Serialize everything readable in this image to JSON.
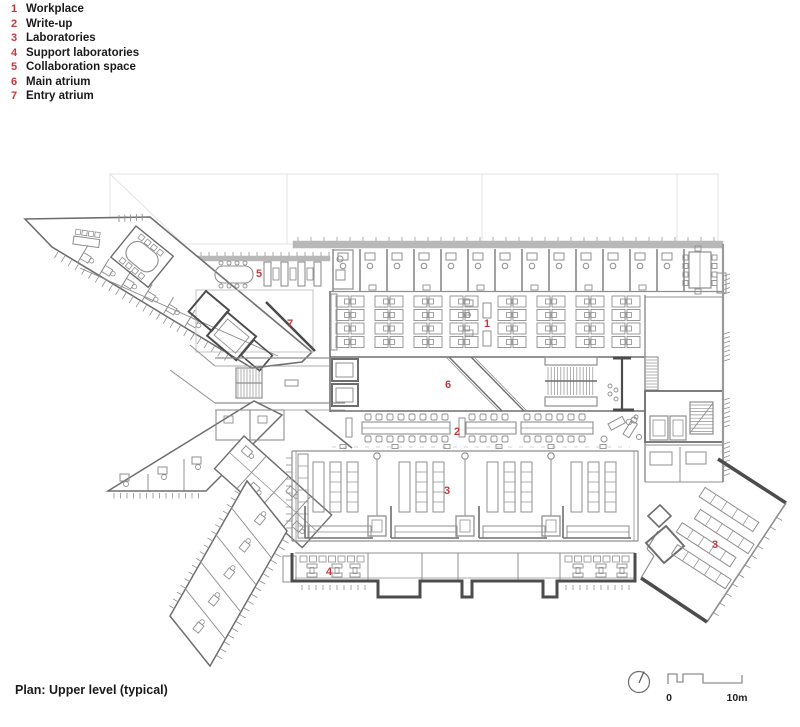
{
  "legend": {
    "items": [
      {
        "num": "1",
        "label": "Workplace"
      },
      {
        "num": "2",
        "label": "Write-up"
      },
      {
        "num": "3",
        "label": "Laboratories"
      },
      {
        "num": "4",
        "label": "Support laboratories"
      },
      {
        "num": "5",
        "label": "Collaboration space"
      },
      {
        "num": "6",
        "label": "Main atrium"
      },
      {
        "num": "7",
        "label": "Entry atrium"
      }
    ]
  },
  "caption": "Plan: Upper level (typical)",
  "plan_labels": [
    {
      "num": "5",
      "x": 259,
      "y": 277
    },
    {
      "num": "7",
      "x": 290,
      "y": 327
    },
    {
      "num": "1",
      "x": 487,
      "y": 327
    },
    {
      "num": "6",
      "x": 448,
      "y": 388
    },
    {
      "num": "2",
      "x": 457,
      "y": 435
    },
    {
      "num": "3",
      "x": 447,
      "y": 494
    },
    {
      "num": "4",
      "x": 329,
      "y": 575
    },
    {
      "num": "3",
      "x": 715,
      "y": 548
    }
  ],
  "scale_bar": {
    "start_label": "0",
    "end_label": "10m"
  },
  "icons": {
    "north": "north-arrow"
  },
  "colors": {
    "accent_red": "#c23a40",
    "line": "#8f8f8f",
    "line_mid": "#6e6e6e",
    "line_dark": "#4c4c4c",
    "line_light": "#c4c4c4",
    "line_faint": "#e3e3e3",
    "wall_fill": "#b8b8b8"
  }
}
